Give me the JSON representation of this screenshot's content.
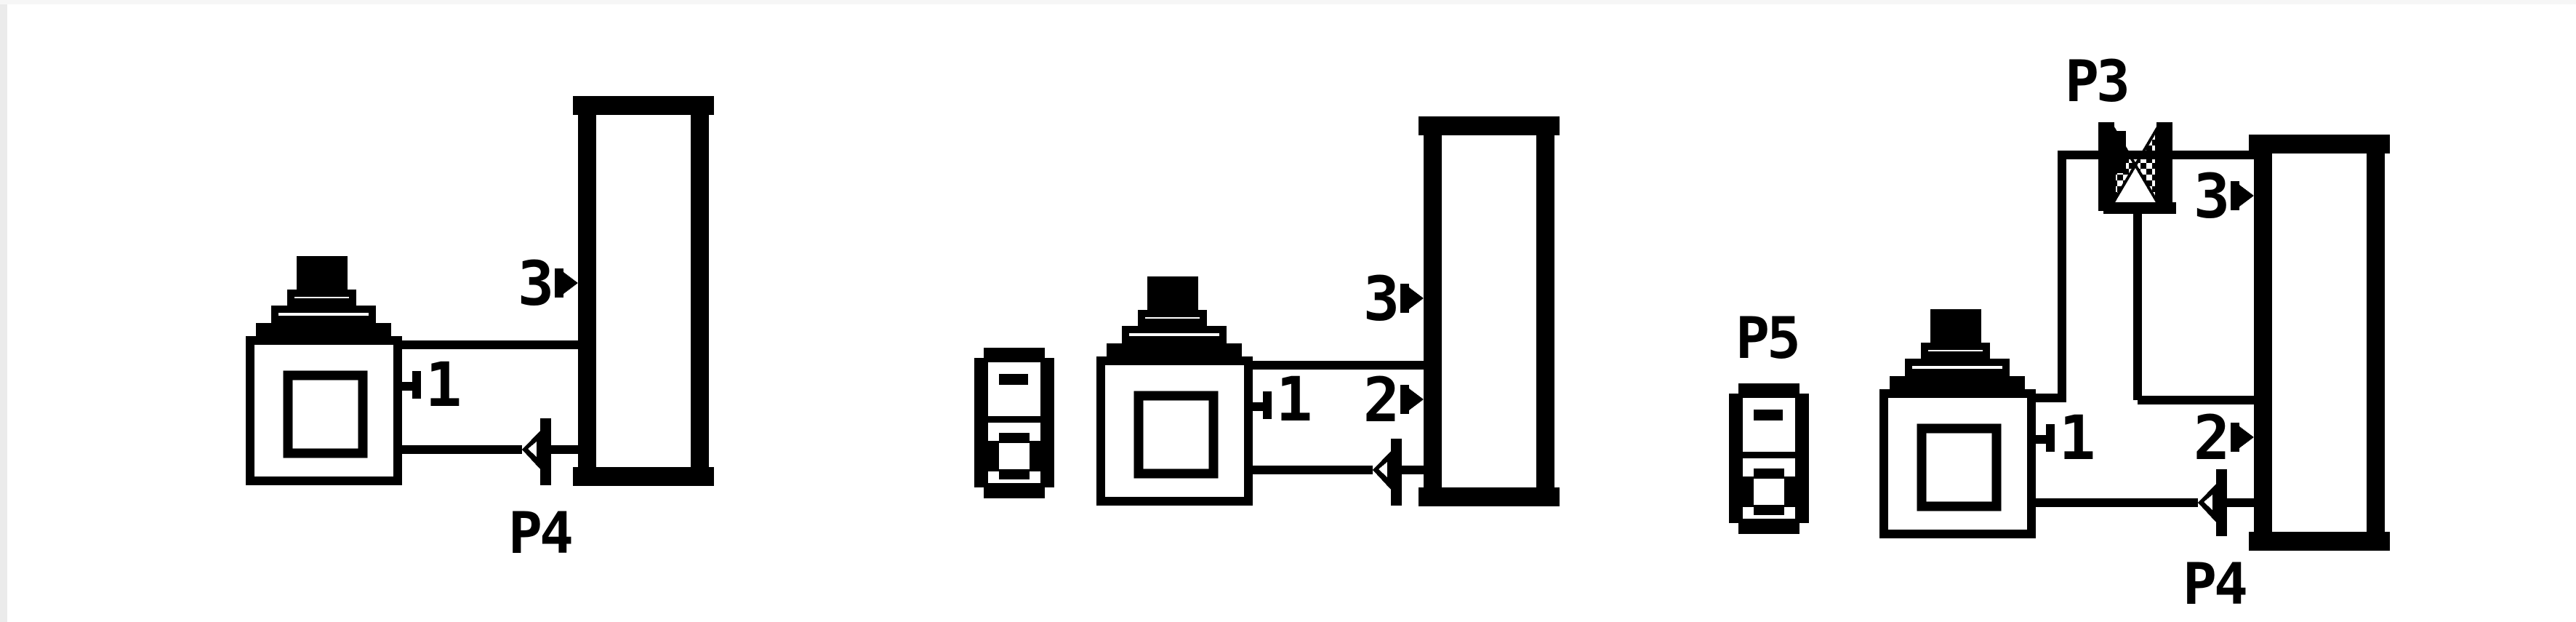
{
  "page": {
    "background": "#ffffff",
    "ink_color": "#000000",
    "stream_label_color": "#e51408",
    "style": "pixelated flowsheet icons"
  },
  "diagrams": [
    {
      "name": "flowsheet-stage-1",
      "icons": [
        "pot-vessel-icon",
        "column-icon",
        "check-valve-icon"
      ],
      "ports": {
        "vessel": "1",
        "column_upper": "3"
      },
      "stream_labels": {
        "bottom_valve": "P4"
      }
    },
    {
      "name": "flowsheet-stage-2",
      "icons": [
        "aux-unit-icon",
        "pot-vessel-icon",
        "column-icon",
        "check-valve-icon"
      ],
      "ports": {
        "vessel": "1",
        "column_upper": "3",
        "column_middle": "2"
      },
      "stream_labels": {}
    },
    {
      "name": "flowsheet-stage-3",
      "icons": [
        "aux-unit-icon",
        "pot-vessel-icon",
        "column-icon",
        "check-valve-icon",
        "crosshatch-valve-icon"
      ],
      "ports": {
        "vessel": "1",
        "column_upper": "3",
        "column_middle": "2"
      },
      "stream_labels": {
        "top_valve": "P3",
        "aux_unit": "P5",
        "bottom_valve": "P4"
      }
    }
  ]
}
